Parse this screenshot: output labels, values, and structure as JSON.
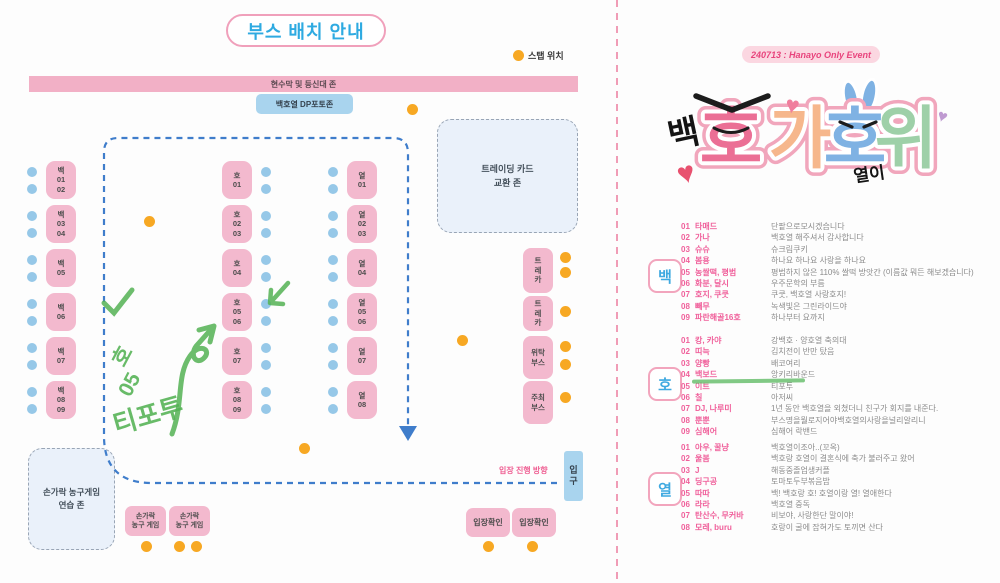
{
  "colors": {
    "booth_pink": "#f3b9ce",
    "attendee_blue": "#96c8e8",
    "staff_orange": "#f7a823",
    "path_blue": "#3f7dcb",
    "marker_green": "#54b254",
    "list_pink": "#f0609b",
    "badge_blue": "#3fa9e0",
    "title_blue": "#2eaae1"
  },
  "icons": {
    "heart": "♥",
    "staff_dot": "orange-circle",
    "attendee_dot": "blue-circle"
  },
  "left_page": {
    "title": "부스 배치 안내",
    "legend_label": "스탭 위치",
    "banner": "현수막 및 등신대 존",
    "dp_zone": "백호열 DP포토존",
    "trading_zone": "트레이딩 카드\n교환 존",
    "practice_zone": "손가락 농구게임\n연습 존",
    "entry_direction": "입장 진행 방향",
    "entrance": "입\n구",
    "booths": {
      "baek": [
        "백\n01\n02",
        "백\n03\n04",
        "백\n05",
        "백\n06",
        "백\n07",
        "백\n08\n09"
      ],
      "ho": [
        "호\n01",
        "호\n02\n03",
        "호\n04",
        "호\n05\n06",
        "호\n07",
        "호\n08\n09"
      ],
      "yeol": [
        "열\n01",
        "열\n02\n03",
        "열\n04",
        "열\n05\n06",
        "열\n07",
        "열\n08"
      ]
    },
    "side_booths": {
      "treka1": "트\n레\n카",
      "treka2": "트\n레\n카",
      "witak": "위탁\n부스",
      "juchoe": "주최\n부스"
    },
    "game_booth": "손가락\n농구 게임",
    "entry_check": "입장확인",
    "annotation": {
      "part1": "호",
      "part2": "05",
      "part3": "티포투"
    }
  },
  "right_page": {
    "event_date": "240713 : Hanayo Only Event",
    "logo": {
      "prefix": "백",
      "char1": "호",
      "char2": "가",
      "char3": "호",
      "char4": "위",
      "suffix": "열이"
    },
    "sections": [
      {
        "badge": "백",
        "rows": [
          {
            "no": "01",
            "name": "타매드",
            "desc": "단팥으로모시겠습니다"
          },
          {
            "no": "02",
            "name": "가나",
            "desc": "백호열 해주셔서 감사합니다"
          },
          {
            "no": "03",
            "name": "슈슈",
            "desc": "슈크림쿠키"
          },
          {
            "no": "04",
            "name": "봄용",
            "desc": "하나요 하나요 사랑을 하나요"
          },
          {
            "no": "05",
            "name": "농쌀떡, 평범",
            "desc": "평범하지 않은 110% 쌀떡 방앗간 (이름값 뭐든 해보겠습니다)"
          },
          {
            "no": "06",
            "name": "화분, 달시",
            "desc": "우주문학의 부름"
          },
          {
            "no": "07",
            "name": "호지, 쿠쿳",
            "desc": "쿠쿳, 백호열 사랑호지!"
          },
          {
            "no": "08",
            "name": "빼무",
            "desc": "녹색빛은 그린라이드야"
          },
          {
            "no": "09",
            "name": "파란해골16호",
            "desc": "하나부터 요까지"
          }
        ]
      },
      {
        "badge": "호",
        "rows": [
          {
            "no": "01",
            "name": "캉, 카야",
            "desc": "강백호 · 양호열 축의대"
          },
          {
            "no": "02",
            "name": "띠늑",
            "desc": "김치전이 반만 탔음"
          },
          {
            "no": "03",
            "name": "양빵",
            "desc": "배코여리"
          },
          {
            "no": "04",
            "name": "백보드",
            "desc": "앙키리바운드"
          },
          {
            "no": "05",
            "name": "이트",
            "desc": "티포투"
          },
          {
            "no": "06",
            "name": "칠",
            "desc": "아저씨"
          },
          {
            "no": "07",
            "name": "DJ, 나루미",
            "desc": "1년 동안 백호열을 외쳤더니 친구가 회지를 내준다."
          },
          {
            "no": "08",
            "name": "뿐뿐",
            "desc": "부스명을뭘로지어야백호열의사랑을널리알리니"
          },
          {
            "no": "09",
            "name": "심해어",
            "desc": "심해어 락밴드"
          }
        ],
        "marker_underline_row": 4
      },
      {
        "badge": "열",
        "rows": [
          {
            "no": "01",
            "name": "아우, 꿀냥",
            "desc": "백호열이조아..(꼬옥)"
          },
          {
            "no": "02",
            "name": "울봄",
            "desc": "백호랑 호열이 결혼식에 축가 불러주고 왔어"
          },
          {
            "no": "03",
            "name": "J",
            "desc": "해동중졸업생커플"
          },
          {
            "no": "04",
            "name": "딩구공",
            "desc": "토마토두부볶음밥"
          },
          {
            "no": "05",
            "name": "따따",
            "desc": "백! 백호랑 호! 호열이랑 열! 열애한다"
          },
          {
            "no": "06",
            "name": "라라",
            "desc": "백호열 중독"
          },
          {
            "no": "07",
            "name": "탄산수, 무커바",
            "desc": "비보야, 사랑한단 말이야!"
          },
          {
            "no": "08",
            "name": "모레, buru",
            "desc": "호랑이 굴에 잡혀가도 토끼면 산다"
          }
        ]
      }
    ]
  }
}
